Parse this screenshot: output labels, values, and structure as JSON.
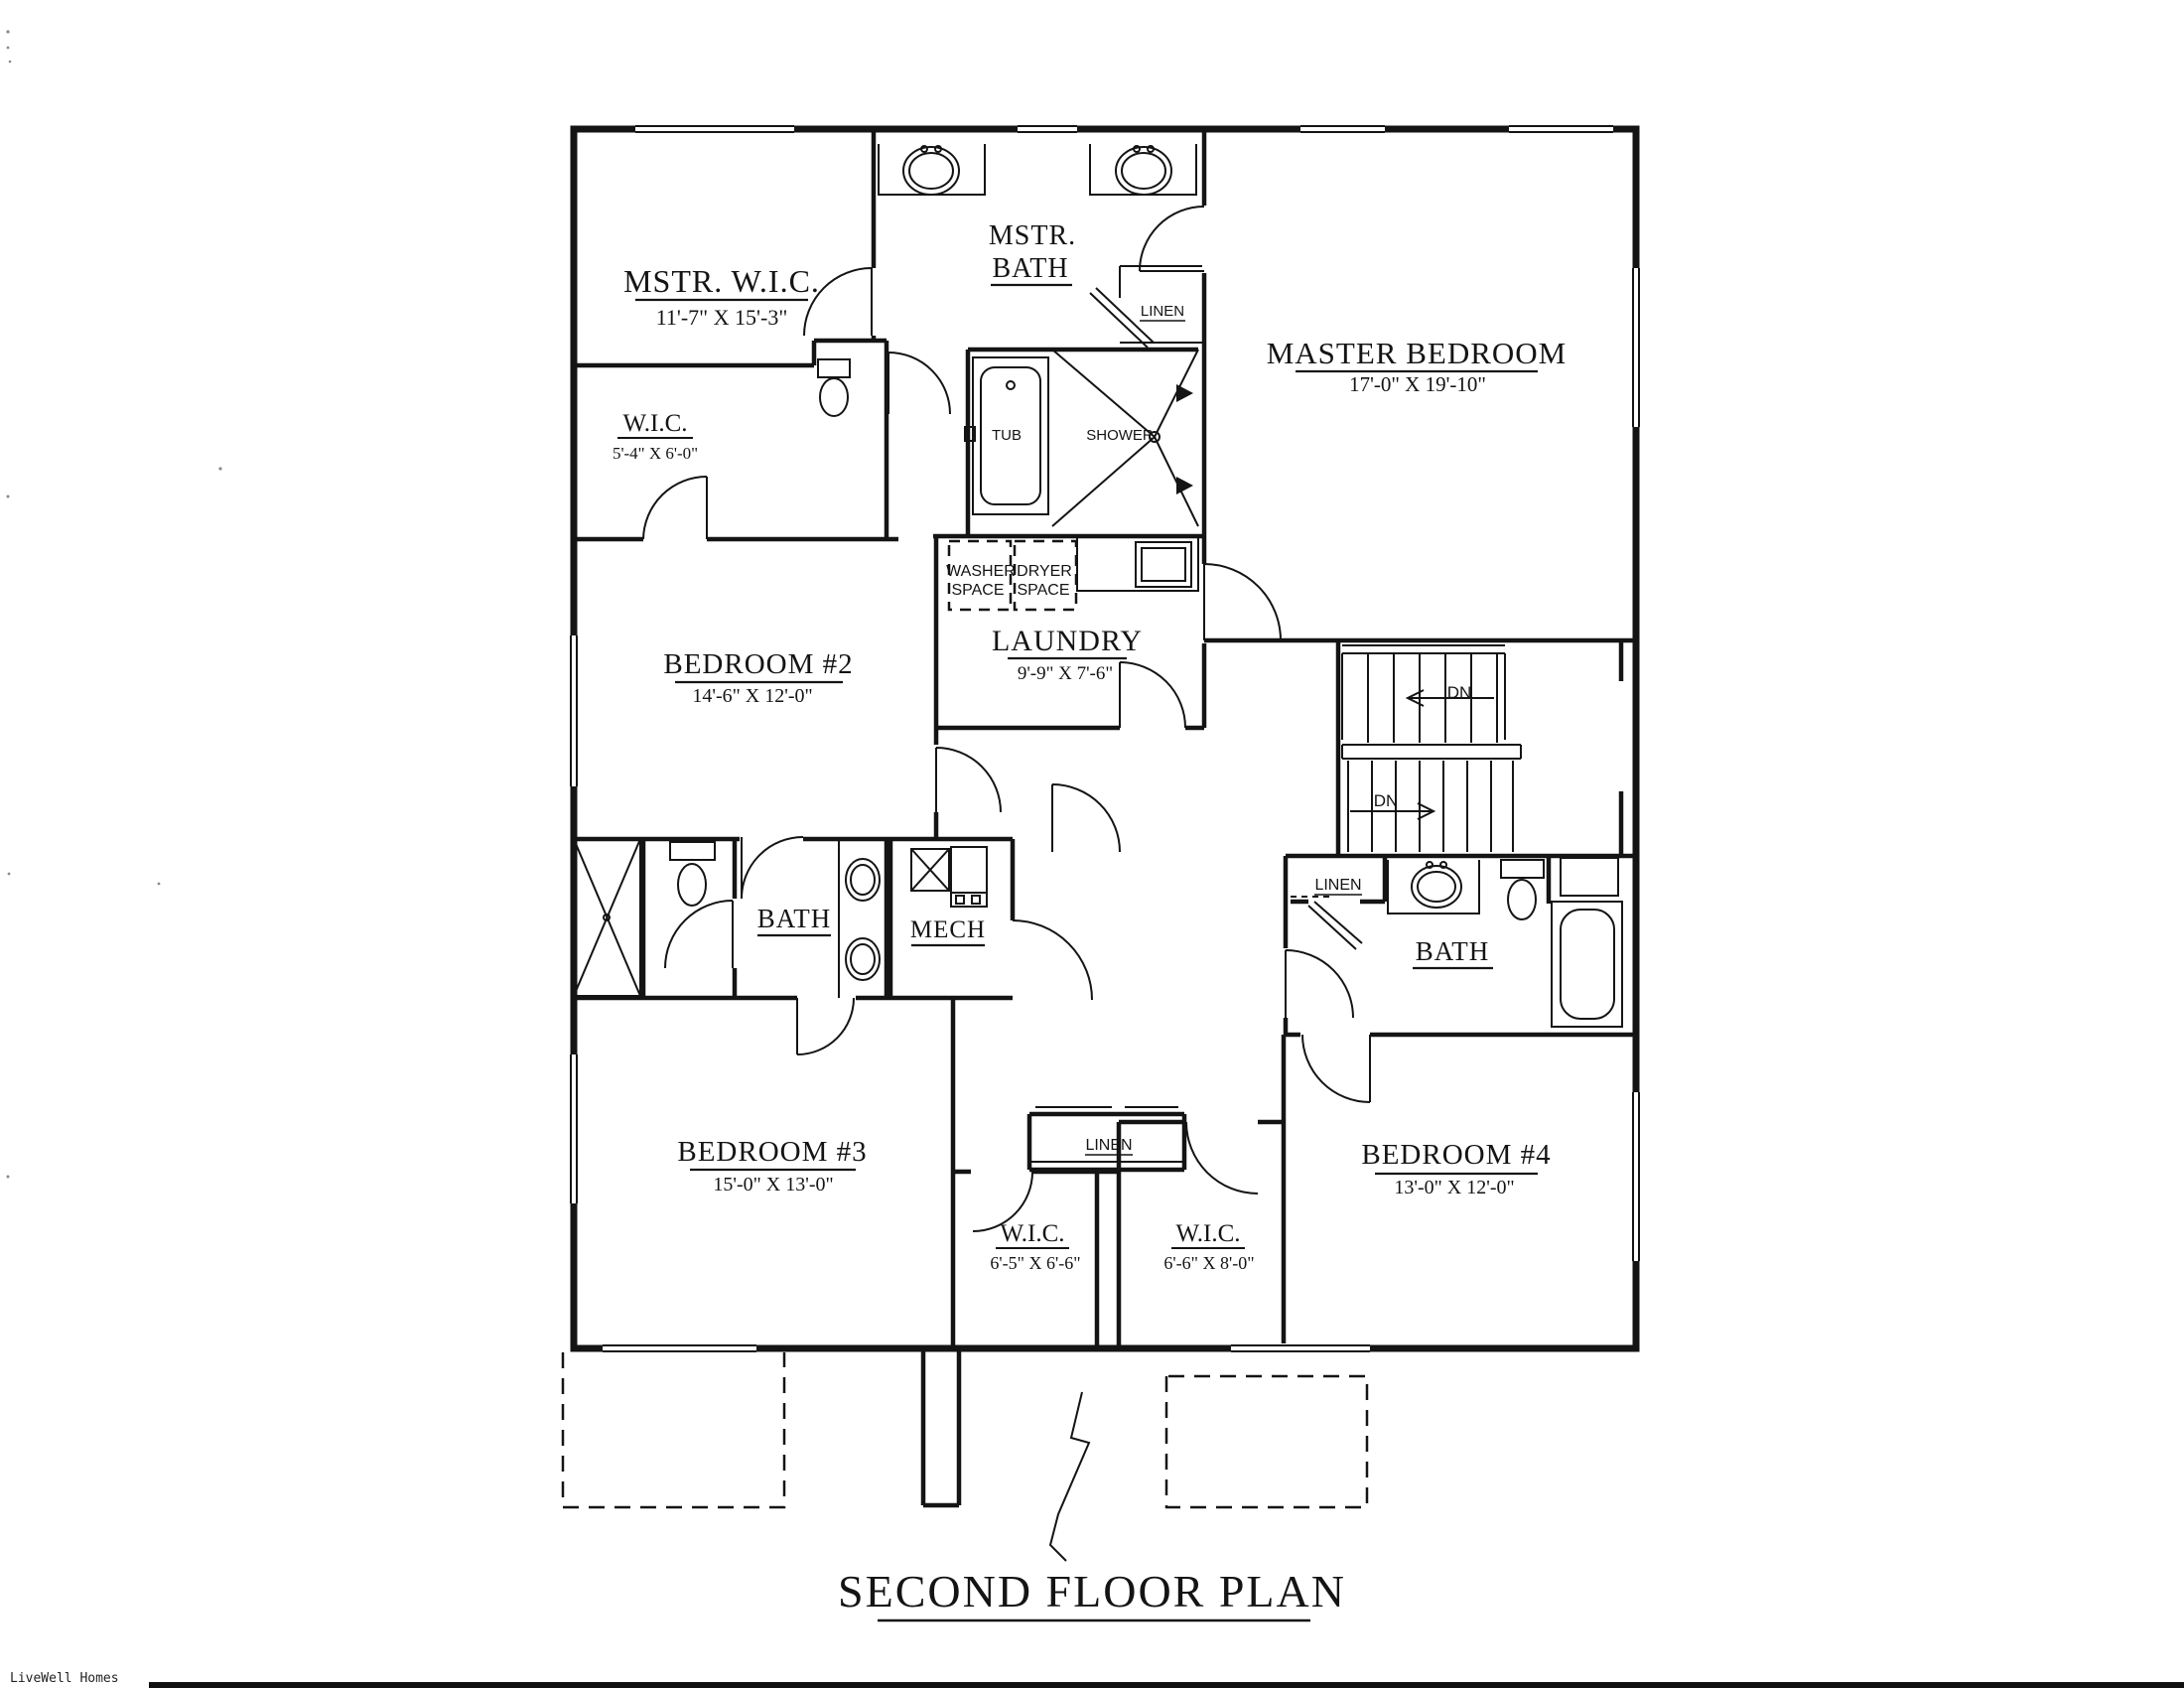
{
  "page": {
    "title": "SECOND FLOOR PLAN",
    "brand": "LiveWell Homes"
  },
  "rooms": {
    "mstr_wic": {
      "name": "MSTR. W.I.C.",
      "dims": "11'-7\" X 15'-3\""
    },
    "wic_small": {
      "name": "W.I.C.",
      "dims": "5'-4\" X 6'-0\""
    },
    "mstr_bath": {
      "name1": "MSTR.",
      "name2": "BATH"
    },
    "master_bedroom": {
      "name": "MASTER BEDROOM",
      "dims": "17'-0\" X 19'-10\""
    },
    "laundry": {
      "name": "LAUNDRY",
      "dims": "9'-9\" X 7'-6\""
    },
    "bedroom2": {
      "name": "BEDROOM #2",
      "dims": "14'-6\" X 12'-0\""
    },
    "bedroom3": {
      "name": "BEDROOM #3",
      "dims": "15'-0\" X 13'-0\""
    },
    "bedroom4": {
      "name": "BEDROOM #4",
      "dims": "13'-0\" X 12'-0\""
    },
    "bath_middle": {
      "name": "BATH"
    },
    "mech": {
      "name": "MECH"
    },
    "bath_right": {
      "name": "BATH"
    },
    "wic_b3": {
      "name": "W.I.C.",
      "dims": "6'-5\" X 6'-6\""
    },
    "wic_b4": {
      "name": "W.I.C.",
      "dims": "6'-6\" X 8'-0\""
    }
  },
  "closets": {
    "linen_mstr": "LINEN",
    "linen_bath_right": "LINEN",
    "linen_hall": "LINEN"
  },
  "fixtures": {
    "tub": "TUB",
    "shower": "SHOWER",
    "washer1": "WASHER",
    "washer2": "SPACE",
    "dryer1": "DRYER",
    "dryer2": "SPACE"
  },
  "stairs": {
    "dn_upper": "DN",
    "dn_lower": "DN"
  },
  "colors": {
    "ink": "#141414",
    "paper": "#ffffff"
  }
}
